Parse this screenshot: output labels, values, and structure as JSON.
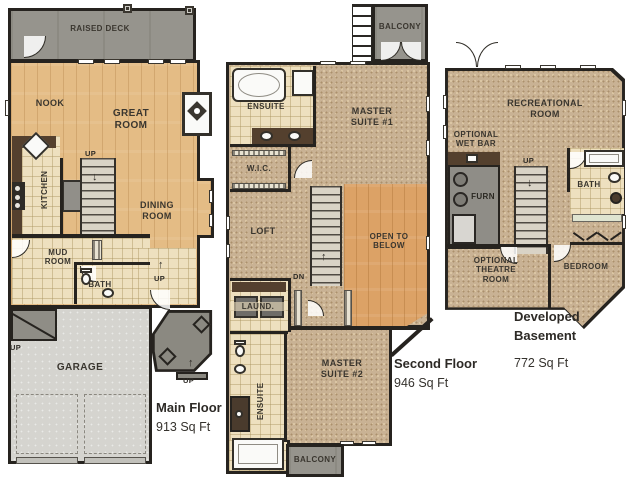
{
  "markers": {
    "up": "UP",
    "dn": "DN"
  },
  "icons": {
    "up_arrow": "↑",
    "down_arrow": "↓"
  },
  "colors": {
    "wall": "#26231f",
    "hardwood": "#e4bc85",
    "hardwood_accent": "#dca266",
    "carpet": "#c9b294",
    "tile": "#eee0bf",
    "deck_gray": "#96948d",
    "porch_gray": "#8b8981",
    "garage_gray": "#d5d4cf",
    "counter_brown": "#54402e"
  },
  "floors": {
    "main": {
      "title": "Main Floor",
      "area": "913 Sq Ft",
      "rooms": {
        "raised_deck": "RAISED DECK",
        "nook": "NOOK",
        "great_room": "GREAT ROOM",
        "kitchen": "KITCHEN",
        "dining_room": "DINING ROOM",
        "mud_room": "MUD ROOM",
        "bath": "BATH",
        "garage": "GARAGE"
      }
    },
    "second": {
      "title": "Second Floor",
      "area": "946 Sq Ft",
      "rooms": {
        "balcony_upper": "BALCONY",
        "ensuite": "ENSUITE",
        "master_suite_1": "MASTER SUITE #1",
        "wic": "W.I.C.",
        "loft": "LOFT",
        "open_to_below": "OPEN TO BELOW",
        "laundry": "LAUND.",
        "master_suite_2": "MASTER SUITE #2",
        "ensuite_2": "ENSUITE",
        "balcony_lower": "BALCONY"
      }
    },
    "basement": {
      "title": "Developed Basement",
      "area": "772 Sq Ft",
      "rooms": {
        "recreational_room": "RECREATIONAL ROOM",
        "optional_wet_bar": "OPTIONAL WET BAR",
        "furnace": "FURN",
        "bath": "BATH",
        "optional_theatre_room": "OPTIONAL THEATRE ROOM",
        "bedroom": "BEDROOM"
      }
    }
  }
}
